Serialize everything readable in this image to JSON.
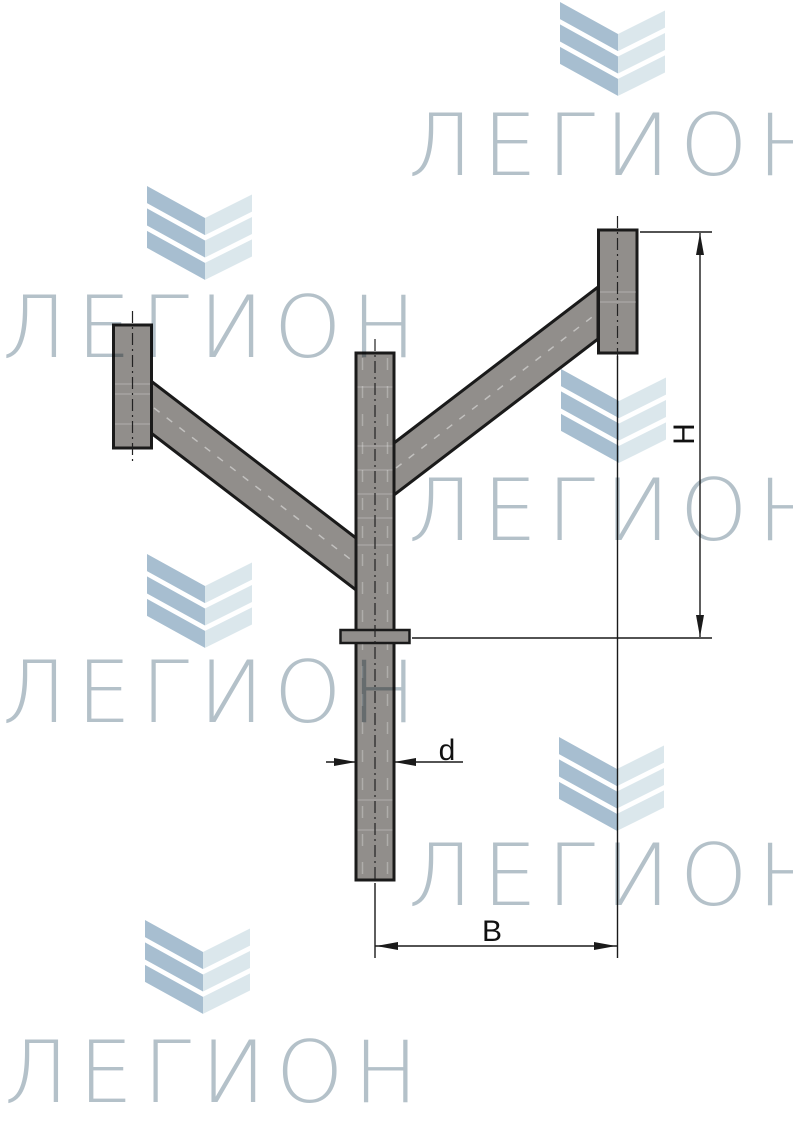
{
  "watermark": {
    "text": "ЛЕГИОН",
    "text_color": "#b4c1c9",
    "chevron_dark_color": "#a7bed0",
    "chevron_light_color": "#dbe7ec"
  },
  "drawing": {
    "part_color": "#918e8b",
    "outline_color": "#1a1a1a",
    "dimensions": {
      "height_label": "H",
      "span_label": "B",
      "diameter_label": "d"
    }
  }
}
